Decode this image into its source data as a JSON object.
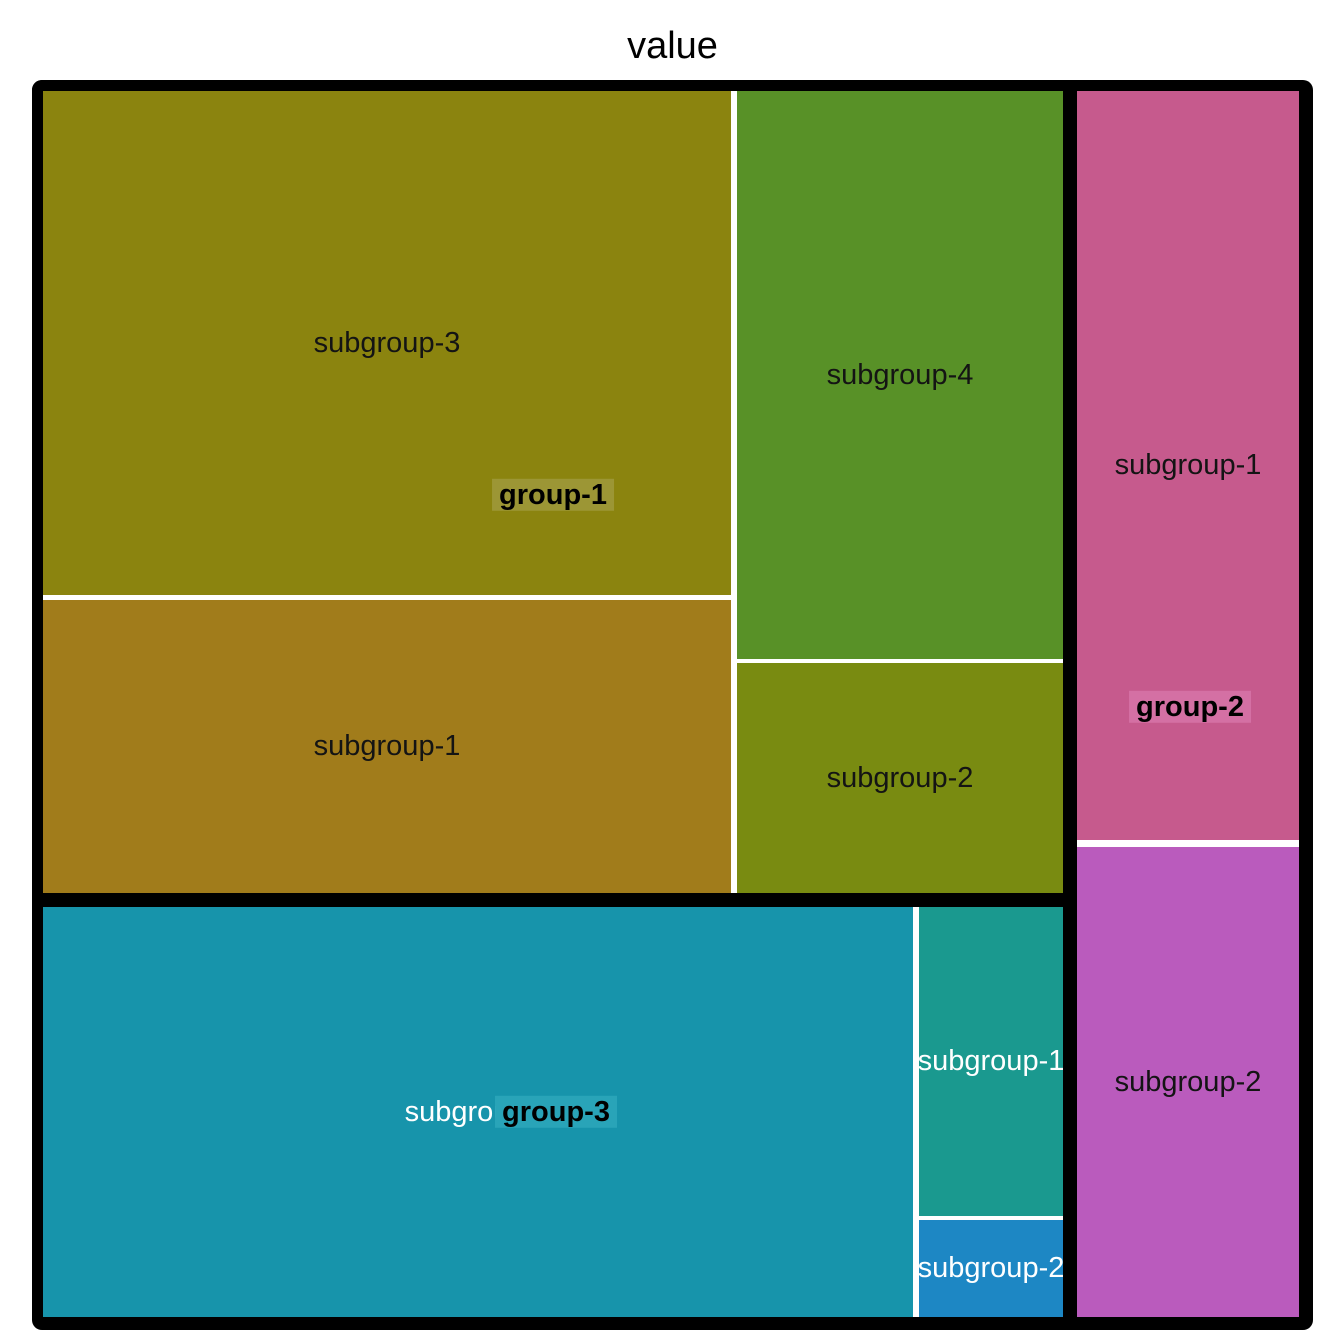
{
  "chart_data": {
    "type": "treemap",
    "title": "value",
    "legend": "none",
    "frame": {
      "x": 32,
      "y": 80,
      "w": 1281,
      "h": 1250,
      "border_color": "#000000"
    },
    "group_border_px": 11,
    "groups": [
      {
        "name": "group-1",
        "label_highlight_color": "#9C9635",
        "label_text_color": "#000000",
        "label_center": {
          "x": 553,
          "y": 495
        },
        "rect": {
          "x": 32,
          "y": 80,
          "w": 1042,
          "h": 824
        },
        "children": [
          {
            "name": "subgroup-3",
            "area_fraction": 0.232,
            "color": "#8B840F",
            "text_color": "#141414",
            "rect": {
              "x": 43,
              "y": 91,
              "w": 688,
              "h": 504
            }
          },
          {
            "name": "subgroup-1",
            "area_fraction": 0.135,
            "color": "#A17C1B",
            "text_color": "#141414",
            "rect": {
              "x": 43,
              "y": 600,
              "w": 688,
              "h": 293
            }
          },
          {
            "name": "subgroup-4",
            "area_fraction": 0.124,
            "color": "#589127",
            "text_color": "#141414",
            "rect": {
              "x": 737,
              "y": 91,
              "w": 326,
              "h": 568
            }
          },
          {
            "name": "subgroup-2",
            "area_fraction": 0.05,
            "color": "#798B11",
            "text_color": "#141414",
            "rect": {
              "x": 737,
              "y": 663,
              "w": 326,
              "h": 230
            }
          }
        ]
      },
      {
        "name": "group-2",
        "label_highlight_color": "#D470A4",
        "label_text_color": "#000000",
        "label_center": {
          "x": 1190,
          "y": 707
        },
        "rect": {
          "x": 1066,
          "y": 80,
          "w": 244,
          "h": 1248
        },
        "children": [
          {
            "name": "subgroup-1",
            "area_fraction": 0.111,
            "color": "#C65A8D",
            "text_color": "#141414",
            "rect": {
              "x": 1077,
              "y": 91,
              "w": 222,
              "h": 749
            }
          },
          {
            "name": "subgroup-2",
            "area_fraction": 0.07,
            "color": "#BA5BBD",
            "text_color": "#141414",
            "rect": {
              "x": 1077,
              "y": 847,
              "w": 222,
              "h": 470
            }
          }
        ]
      },
      {
        "name": "group-3",
        "label_highlight_color": "#29A4B8",
        "label_text_color": "#000000",
        "label_center": {
          "x": 556,
          "y": 1112
        },
        "rect": {
          "x": 32,
          "y": 896,
          "w": 1042,
          "h": 432
        },
        "children": [
          {
            "name": "subgroup-3",
            "area_fraction": 0.239,
            "color": "#1794AB",
            "text_color": "#FFFFFF",
            "rect": {
              "x": 43,
              "y": 907,
              "w": 870,
              "h": 410
            }
          },
          {
            "name": "subgroup-1",
            "area_fraction": 0.03,
            "color": "#1A998F",
            "text_color": "#FFFFFF",
            "rect": {
              "x": 919,
              "y": 907,
              "w": 144,
              "h": 309
            }
          },
          {
            "name": "subgroup-2",
            "area_fraction": 0.009,
            "color": "#1D87C4",
            "text_color": "#FFFFFF",
            "rect": {
              "x": 919,
              "y": 1220,
              "w": 144,
              "h": 97
            }
          }
        ]
      }
    ]
  }
}
